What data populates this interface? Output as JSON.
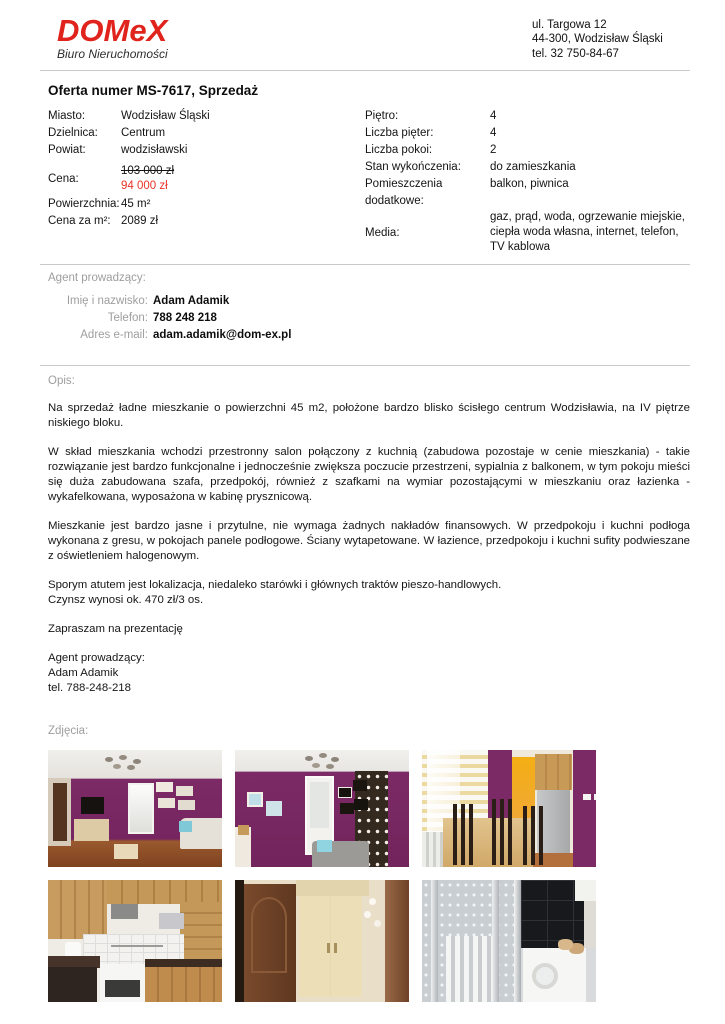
{
  "header": {
    "brand": "DOMeX",
    "brand_sub": "Biuro Nieruchomości",
    "address": [
      "ul. Targowa 12",
      "44-300, Wodzisław Śląski",
      "tel. 32 750-84-67"
    ]
  },
  "offer": {
    "heading": "Oferta numer MS-7617, Sprzedaż",
    "left": [
      {
        "label": "Miasto:",
        "value": "Wodzisław Śląski"
      },
      {
        "label": "Dzielnica:",
        "value": "Centrum"
      },
      {
        "label": "Powiat:",
        "value": "wodzisławski"
      }
    ],
    "price": {
      "label": "Cena:",
      "old": "103 000 zł",
      "new": "94 000 zł"
    },
    "left2": [
      {
        "label": "Powierzchnia:",
        "value": "45 m²"
      },
      {
        "label": "Cena za m²:",
        "value": "2089 zł"
      }
    ],
    "right": [
      {
        "label": "Piętro:",
        "value": "4"
      },
      {
        "label": "Liczba pięter:",
        "value": "4"
      },
      {
        "label": "Liczba pokoi:",
        "value": "2"
      },
      {
        "label": "Stan wykończenia:",
        "value": "do zamieszkania"
      },
      {
        "label": "Pomieszczenia dodatkowe:",
        "value": "balkon, piwnica"
      },
      {
        "label": "Media:",
        "value": "gaz, prąd, woda, ogrzewanie miejskie, ciepła woda własna, internet, telefon, TV kablowa"
      }
    ]
  },
  "agent": {
    "heading": "Agent prowadzący:",
    "rows": [
      {
        "label": "Imię i nazwisko:",
        "value": "Adam Adamik"
      },
      {
        "label": "Telefon:",
        "value": "788 248 218"
      },
      {
        "label": "Adres e-mail:",
        "value": "adam.adamik@dom-ex.pl"
      }
    ]
  },
  "description": {
    "heading": "Opis:",
    "p1": "Na sprzedaż ładne mieszkanie o powierzchni 45 m2, położone bardzo blisko ścisłego centrum Wodzisławia, na IV piętrze niskiego bloku.",
    "p2": "W skład mieszkania wchodzi przestronny salon połączony z kuchnią (zabudowa pozostaje w cenie mieszkania) - takie rozwiązanie jest bardzo funkcjonalne i jednocześnie zwiększa poczucie przestrzeni, sypialnia z balkonem, w tym pokoju mieści się duża zabudowana szafa, przedpokój, również z szafkami na wymiar pozostającymi w mieszkaniu oraz łazienka - wykafelkowana, wyposażona w kabinę prysznicową.",
    "p3": "Mieszkanie jest bardzo jasne i przytulne, nie wymaga żadnych nakładów finansowych. W przedpokoju i kuchni podłoga wykonana z gresu, w pokojach panele podłogowe. Ściany wytapetowane. W łazience, przedpokoju i kuchni sufity podwieszane z oświetleniem halogenowym.",
    "p4a": "Sporym atutem jest lokalizacja, niedaleko starówki i głównych traktów pieszo-handlowych.",
    "p4b": "Czynsz wynosi ok. 470 zł/3 os.",
    "closing": "Zapraszam na prezentację",
    "sig1": "Agent prowadzący:",
    "sig2": "Adam Adamik",
    "sig3": "tel. 788-248-218"
  },
  "photos": {
    "heading": "Zdjęcia:",
    "items": [
      {
        "name": "living-room-view-1"
      },
      {
        "name": "living-room-view-2"
      },
      {
        "name": "dining-area-kitchen"
      },
      {
        "name": "kitchen"
      },
      {
        "name": "hallway-wardrobe"
      },
      {
        "name": "bathroom-shower"
      }
    ]
  },
  "colors": {
    "brand_red": "#e0231c",
    "price_red": "#e8332a",
    "divider": "#c9c9c9",
    "label_gray": "#9e9e9e",
    "photo_purple": "#7c2a66"
  }
}
